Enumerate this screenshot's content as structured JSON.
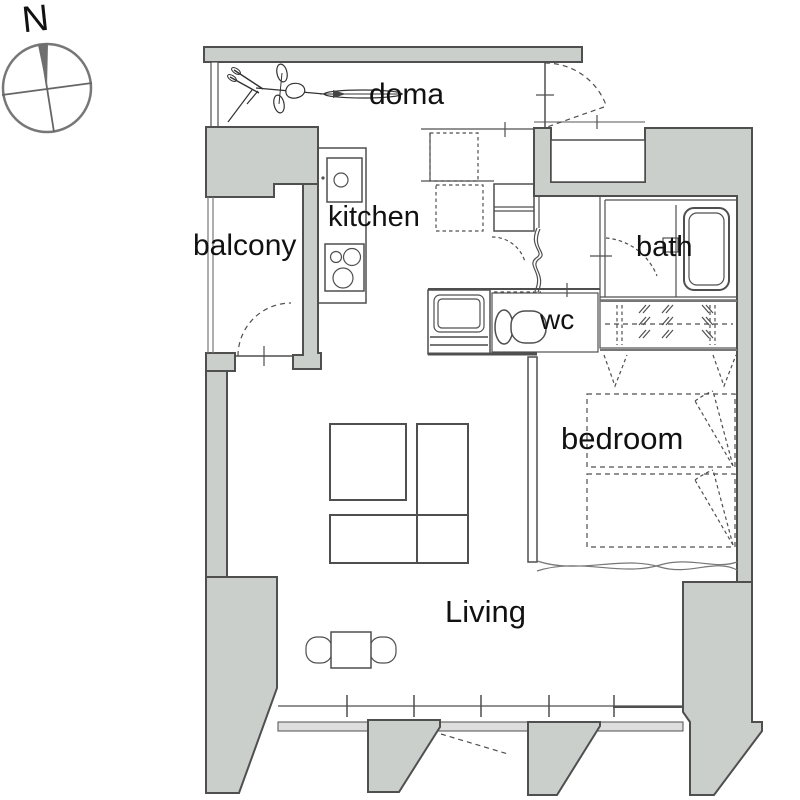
{
  "title": "apartment floor plan",
  "compass": {
    "label": "N"
  },
  "rooms": [
    {
      "id": "doma",
      "label": "doma"
    },
    {
      "id": "kitchen",
      "label": "kitchen"
    },
    {
      "id": "balcony",
      "label": "balcony"
    },
    {
      "id": "bath",
      "label": "bath"
    },
    {
      "id": "wc",
      "label": "wc"
    },
    {
      "id": "bedroom",
      "label": "bedroom"
    },
    {
      "id": "living",
      "label": "Living"
    }
  ],
  "fixtures": [
    "bicycle",
    "kitchen-sink",
    "stove",
    "bathtub",
    "toilet",
    "washbasin",
    "shoe-cabinet",
    "storage-boxes-dashed",
    "wardrobe-hangers",
    "futon-beds",
    "folding-indicator-fans",
    "curtain-partition",
    "accordion-curtain",
    "door-swing-arcs",
    "sliding-windows",
    "dining-table-with-chairs",
    "living-tables",
    "compass-rose"
  ],
  "colors": {
    "background": "#ffffff",
    "wall_fill": "#cbcfcb",
    "line": "#4f4f4f",
    "thin_line": "#777777",
    "text": "#111111"
  }
}
